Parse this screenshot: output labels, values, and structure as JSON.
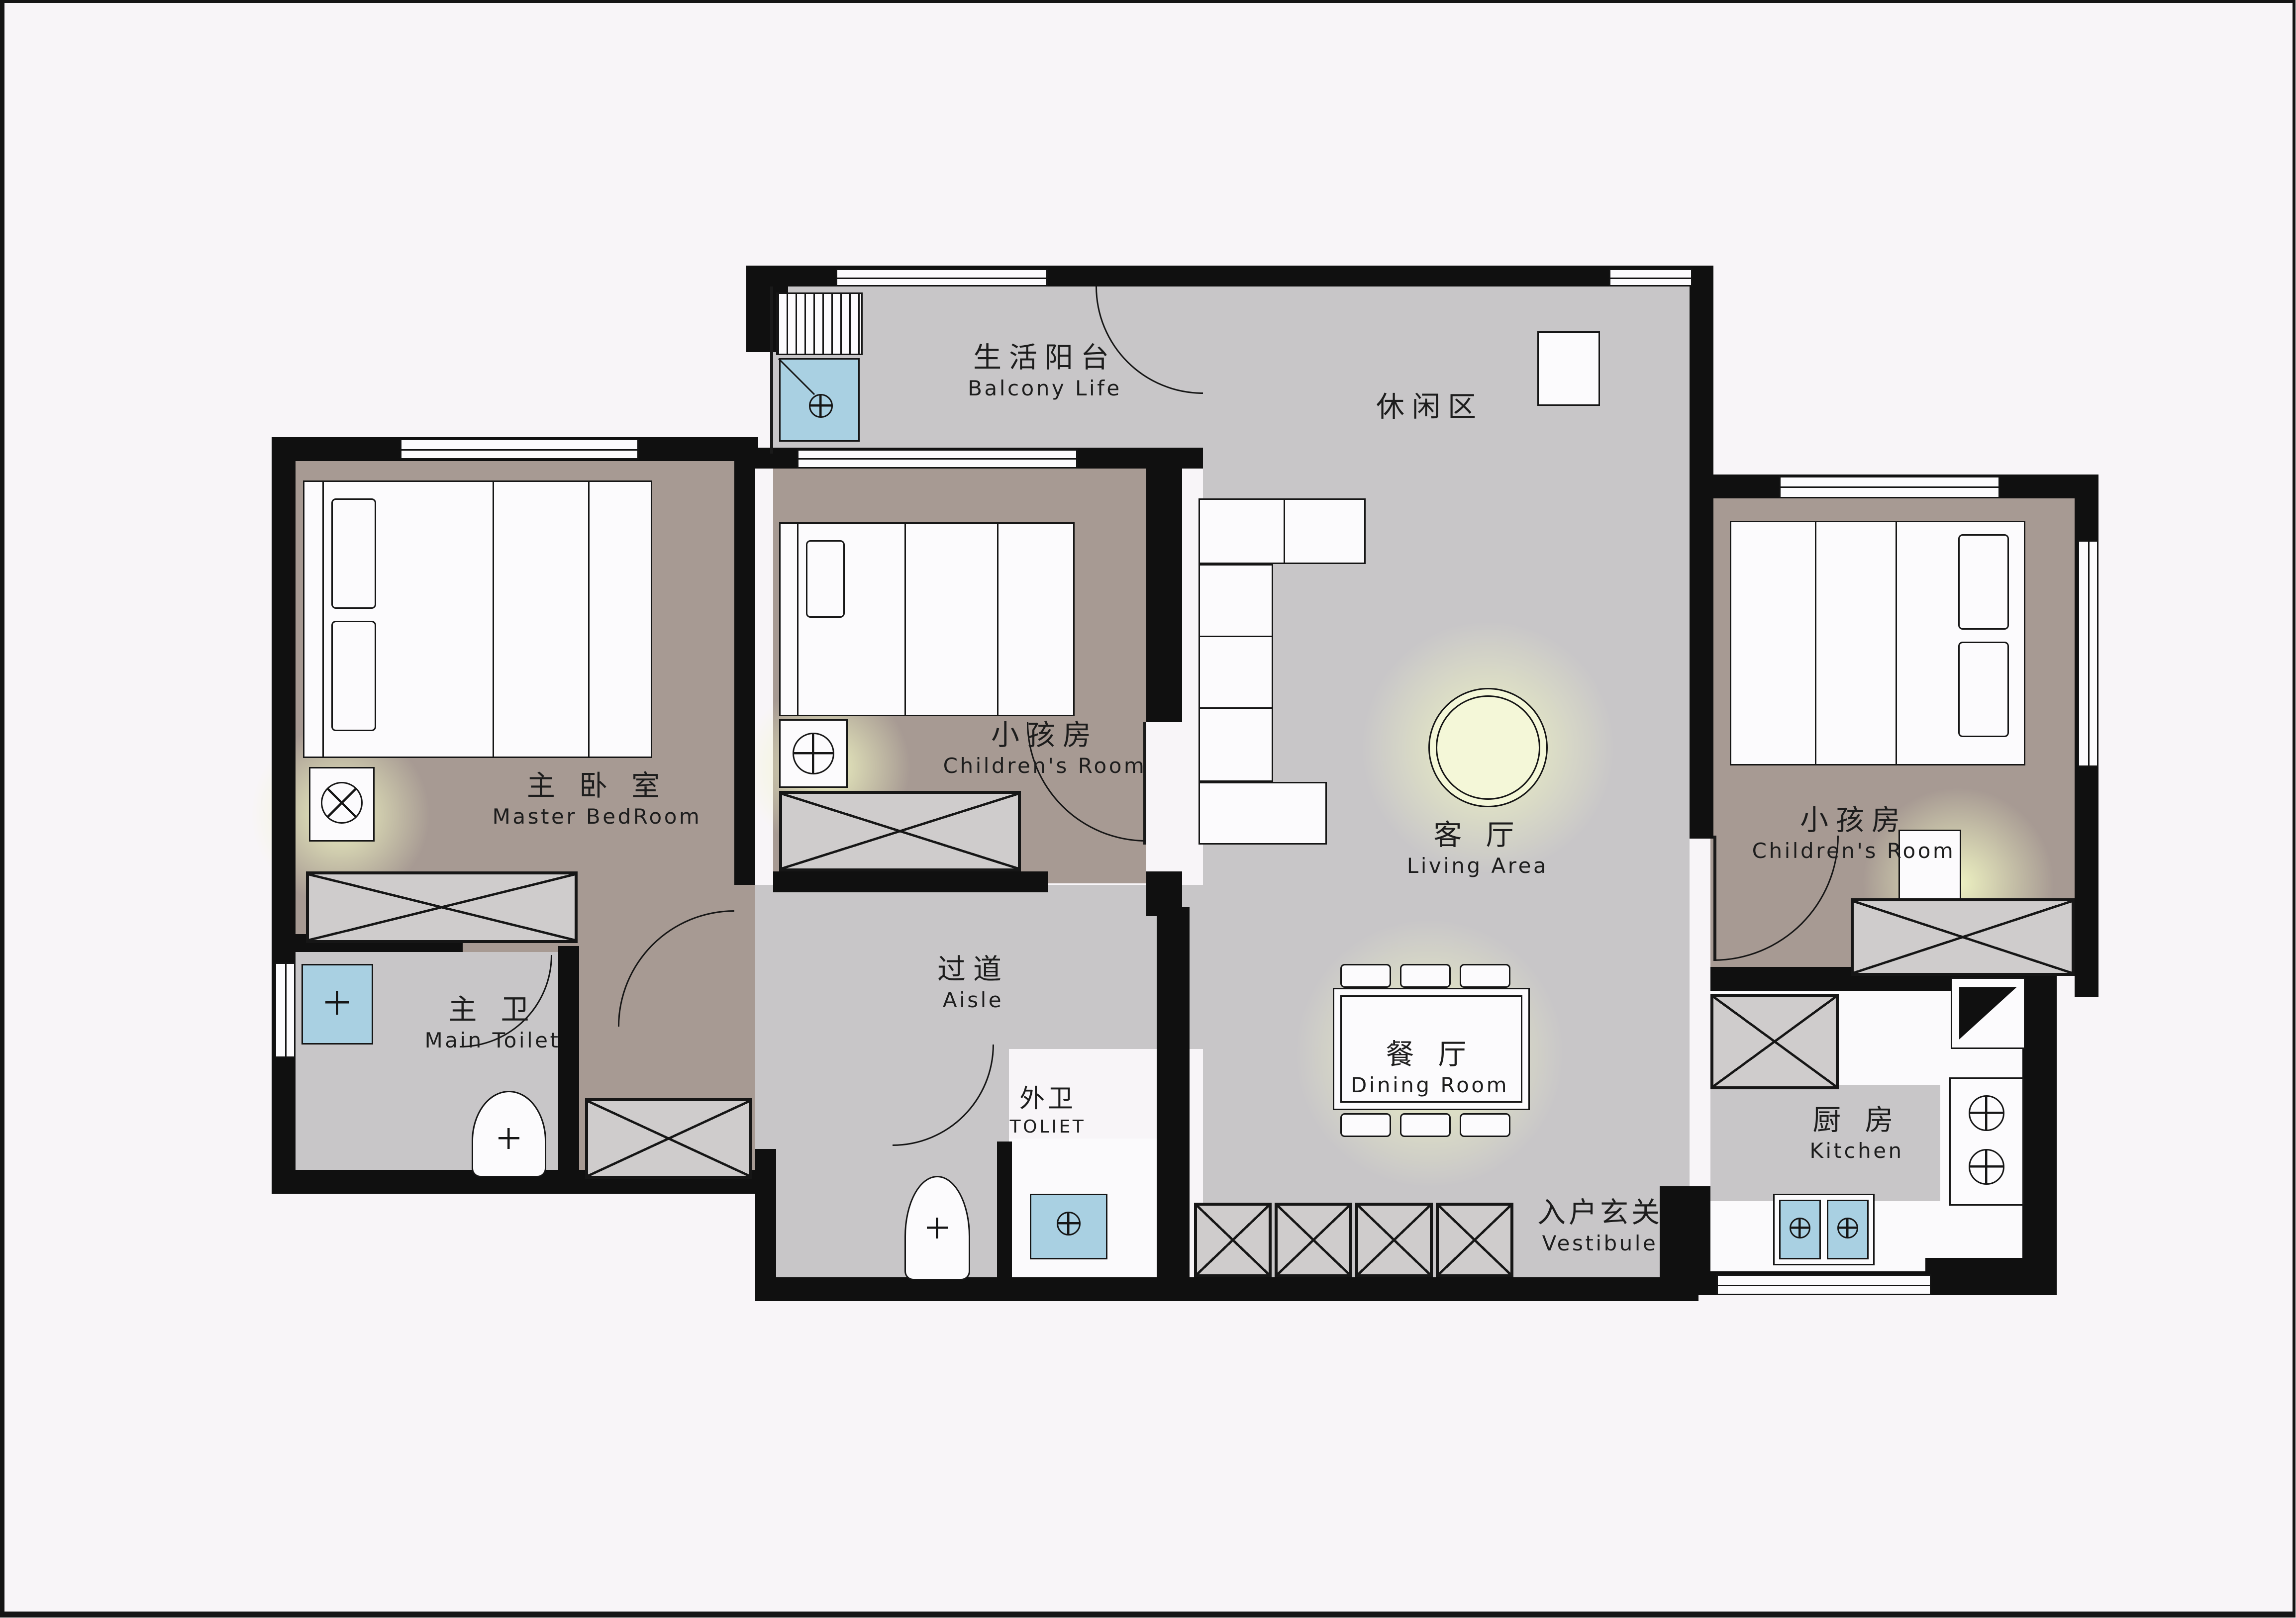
{
  "title": "Apartment Floor Plan",
  "colors": {
    "background": "#f8f5f8",
    "floor_gray": "#c8c6c8",
    "floor_taupe": "#a79a93",
    "wall": "#101010",
    "fixture_blue": "#a9d0e2",
    "glow_yellow": "#f1f6c4",
    "furniture_white": "#fcfbfd"
  },
  "rooms": [
    {
      "id": "balcony",
      "zh": "生活阳台",
      "en": "Balcony Life"
    },
    {
      "id": "leisure-area",
      "zh": "休闲区",
      "en": ""
    },
    {
      "id": "master-bedroom",
      "zh": "主 卧 室",
      "en": "Master BedRoom"
    },
    {
      "id": "children-room-center",
      "zh": "小孩房",
      "en": "Children's Room"
    },
    {
      "id": "living-area",
      "zh": "客 厅",
      "en": "Living Area"
    },
    {
      "id": "children-room-right",
      "zh": "小孩房",
      "en": "Children's Room"
    },
    {
      "id": "main-toilet",
      "zh": "主 卫",
      "en": "Main Toilet"
    },
    {
      "id": "aisle",
      "zh": "过道",
      "en": "Aisle"
    },
    {
      "id": "outer-toilet",
      "zh": "外卫",
      "en": "TOLIET"
    },
    {
      "id": "dining-room",
      "zh": "餐 厅",
      "en": "Dining Room"
    },
    {
      "id": "vestibule",
      "zh": "入户玄关",
      "en": "Vestibule"
    },
    {
      "id": "kitchen",
      "zh": "厨 房",
      "en": "Kitchen"
    }
  ],
  "fixtures": [
    "washing-machine",
    "drying-rack",
    "master-bed",
    "bedside-lamp",
    "wardrobe-cabinet",
    "dresser-cabinet",
    "bathroom-sink",
    "toilet-bowl",
    "children-bed",
    "children-wardrobe",
    "l-shaped-sofa",
    "round-rug-ceiling-light",
    "structural-column",
    "dining-table",
    "dining-chairs",
    "shoe-cabinet-row",
    "outer-toilet-bowl",
    "outer-sink",
    "kitchen-cabinet",
    "refrigerator",
    "gas-stove-two-burners",
    "kitchen-double-sink",
    "kitchen-counter"
  ]
}
